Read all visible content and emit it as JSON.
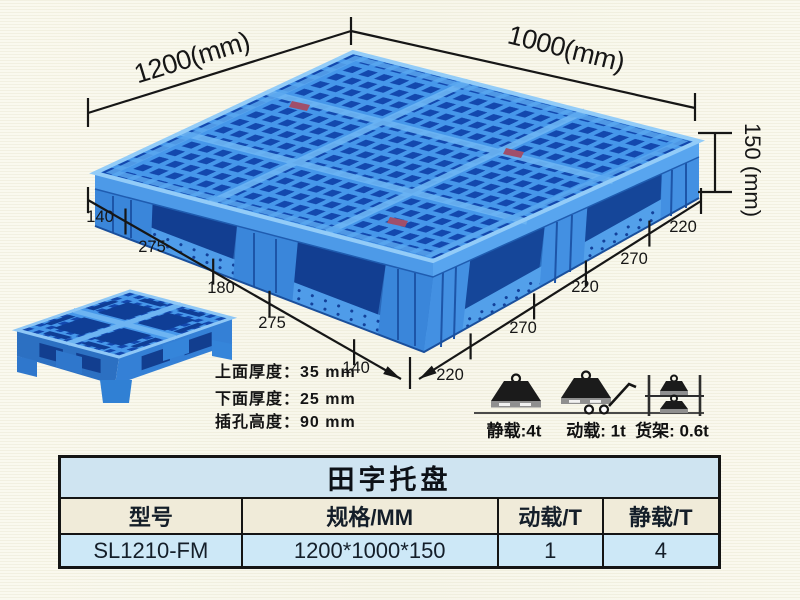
{
  "dims": {
    "width_label": "1200(mm)",
    "depth_label": "1000(mm)",
    "height_label": "150 (mm)",
    "left_chain": [
      "140",
      "275",
      "180",
      "275",
      "140"
    ],
    "right_chain": [
      "220",
      "270",
      "220",
      "270",
      "220"
    ]
  },
  "specs": {
    "top_thickness": "上面厚度：35 mm",
    "bottom_thickness": "下面厚度：25 mm",
    "fork_slot_height": "插孔高度：90 mm"
  },
  "capacity": {
    "static_label": "静载:4t",
    "dynamic_label": "动载: 1t",
    "rack_label": "货架: 0.6t"
  },
  "table": {
    "title": "田字托盘",
    "headers": [
      "型号",
      "规格/MM",
      "动载/T",
      "静载/T"
    ],
    "row": [
      "SL1210-FM",
      "1200*1000*150",
      "1",
      "4"
    ]
  },
  "colors": {
    "pallet_blue": "#3f93e8",
    "pallet_hole_blue": "#1348ae",
    "table_title_bg": "#cfe4f1",
    "table_header_bg": "#f0ebd9",
    "table_row_bg": "#cde8f7",
    "background": "#faf9ef"
  }
}
